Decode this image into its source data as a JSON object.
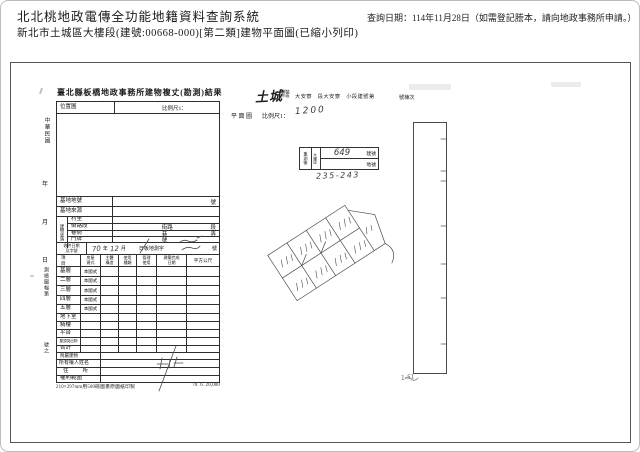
{
  "page": {
    "system_title": "北北桃地政電傳全功能地籍資料查詢系統",
    "query_date": "查詢日期：114年11月28日（如需登記謄本，請向地政事務所申請。）",
    "subtitle": "新北市土城區大樓段(建號:00668-000)[第二類]建物平面圖(已縮小列印)"
  },
  "form": {
    "title": "臺北縣板橋地政事務所建物複丈(勘測)結果",
    "location_label": "位置圖",
    "location_scale_label": "比例尺1：",
    "site_no_label": "基地地號",
    "site_no_suffix": "號",
    "site_src_label": "基地來源",
    "bgroup_label": "建物坐落",
    "village_label": "村里",
    "street_label": "街路段",
    "street_mid": "街路",
    "street_suffix": "段",
    "lane_label": "巷衖",
    "lane_mid": "巷",
    "lane_suffix": "弄",
    "door_label": "門牌",
    "door_mid": "號",
    "receipt_label_1": "收件日期",
    "receipt_label_2": "及字號",
    "receipt_year_hw": "70",
    "receipt_year": "年",
    "receipt_month_hw": "12",
    "receipt_month": "月",
    "receipt_mid": "日板地測字",
    "receipt_suffix": "號",
    "th_item": "項目",
    "th_style_1": "房屋",
    "th_style_2": "建式",
    "th_struct_1": "主體",
    "th_struct_2": "構造",
    "th_use_1": "使用",
    "th_use_2": "種類",
    "th_mgmt_1": "管理",
    "th_mgmt_2": "使用",
    "th_done_1": "建築完成",
    "th_done_2": "日期",
    "th_area": "平方公尺",
    "floors": [
      {
        "label": "基層",
        "style": "本國式"
      },
      {
        "label": "二層",
        "style": "本國式"
      },
      {
        "label": "三層",
        "style": "本國式"
      },
      {
        "label": "四層",
        "style": "本國式"
      },
      {
        "label": "五層",
        "style": "本國式"
      },
      {
        "label": "地下室",
        "style": ""
      },
      {
        "label": "騎樓",
        "style": ""
      },
      {
        "label": "平台",
        "style": ""
      },
      {
        "label": "屋頂突出物",
        "style": ""
      },
      {
        "label": "合計",
        "style": ""
      }
    ],
    "annex_label": "附屬建物",
    "owner_label": "所有權人姓名",
    "addr_label": "住所",
    "rights_label": "權利範圍",
    "paper_note": "210×297mm用500磅圖畫原圖紙印製",
    "print_code": "70. 6. 20,000",
    "margin_era": "中華民國",
    "margin_year": "年",
    "margin_month": "月",
    "margin_day": "日",
    "margin_sheet": "測繪圖幅第",
    "margin_sheet2": "號之"
  },
  "plan": {
    "district_hw": "土城",
    "township_line1": "鄉鎮",
    "township_line2": "市區",
    "section_line": "大安寮　段大安寮　小段建號第",
    "suffix": "號棟次",
    "plan_label": "平面圖",
    "scale_label": "比例尺1：",
    "scale_hw": "1200",
    "stamp": {
      "col1": "重測後",
      "col2": "大樓段",
      "no_hw": "649",
      "no_label": "建號",
      "parcel_label": "地號"
    },
    "parcel_hw": "235-243",
    "strip_note_hw": "1-51"
  }
}
